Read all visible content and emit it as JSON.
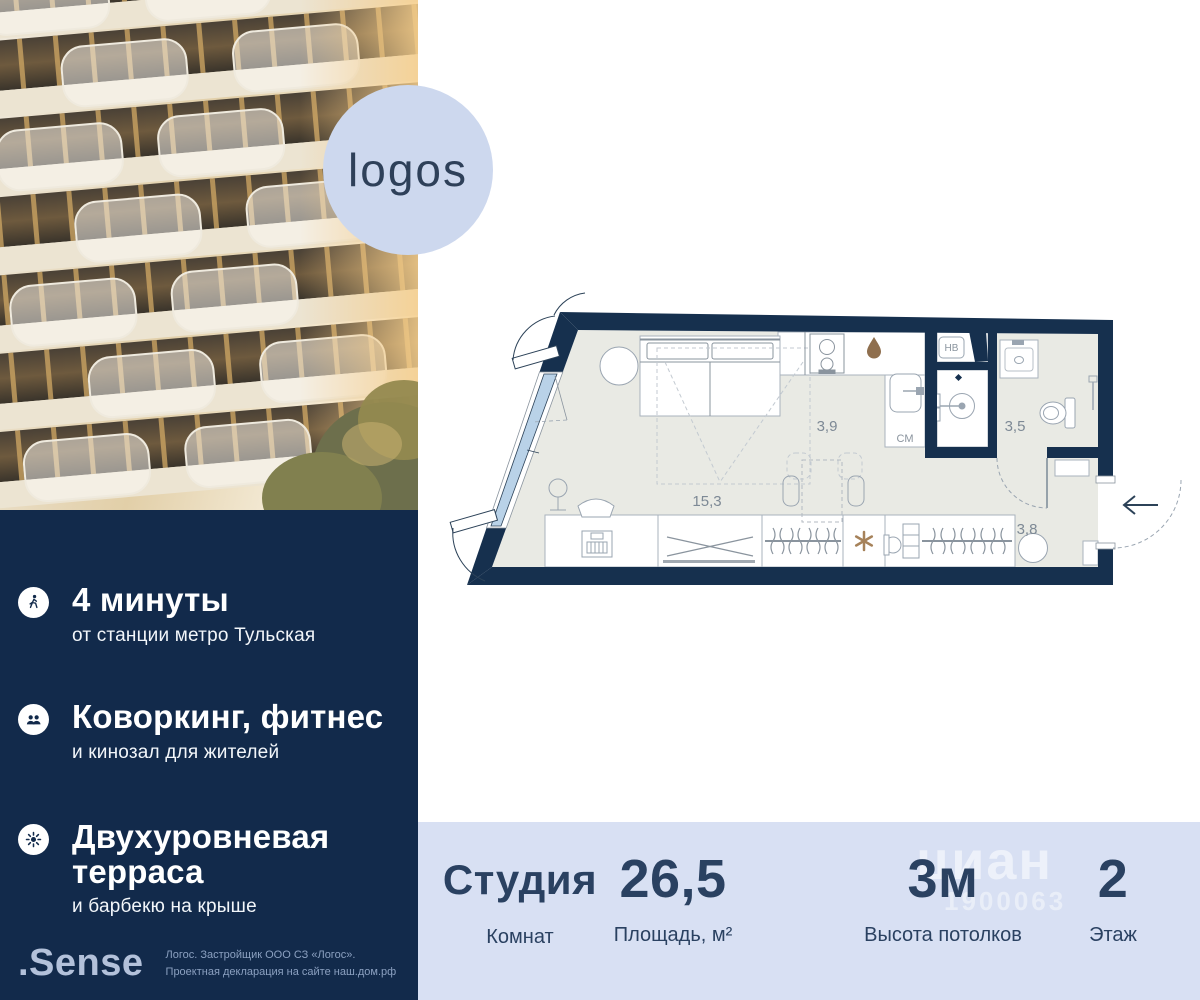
{
  "brand": {
    "logo_badge": "logos",
    "developer_logo": ".Sense",
    "disclaimer_line1": "Логос. Застройщик ООО СЗ «Логос».",
    "disclaimer_line2": "Проектная декларация на сайте наш.дом.рф"
  },
  "features": {
    "items": [
      {
        "icon": "walking-person-icon",
        "title": "4 минуты",
        "subtitle": "от станции метро Тульская"
      },
      {
        "icon": "people-icon",
        "title": "Коворкинг, фитнес",
        "subtitle": "и кинозал для жителей"
      },
      {
        "icon": "sun-icon",
        "title": "Двухуровневая терраса",
        "subtitle": "и барбекю на крыше"
      }
    ]
  },
  "floorplan": {
    "living_area": "15,3",
    "kitchen_area": "3,9",
    "bathroom_area": "3,5",
    "hall_area": "3,8",
    "washing_machine_label": "СМ",
    "water_heater_label": "НВ"
  },
  "stats": {
    "items": [
      {
        "value": "Студия",
        "label": "Комнат"
      },
      {
        "value": "26,5",
        "label": "Площадь, м²"
      },
      {
        "value": "3м",
        "label": "Высота потолков"
      },
      {
        "value": "2",
        "label": "Этаж"
      }
    ]
  },
  "watermark": {
    "name": "циан",
    "id": "1900063"
  },
  "colors": {
    "panel_navy": "#122a4b",
    "stats_bg": "#d8e0f3",
    "stats_text": "#2a4161",
    "logo_circle": "#cdd8ee",
    "wall_navy": "#16304e",
    "window_blue": "#b9d2e8",
    "wood_accent": "#a6825a"
  }
}
